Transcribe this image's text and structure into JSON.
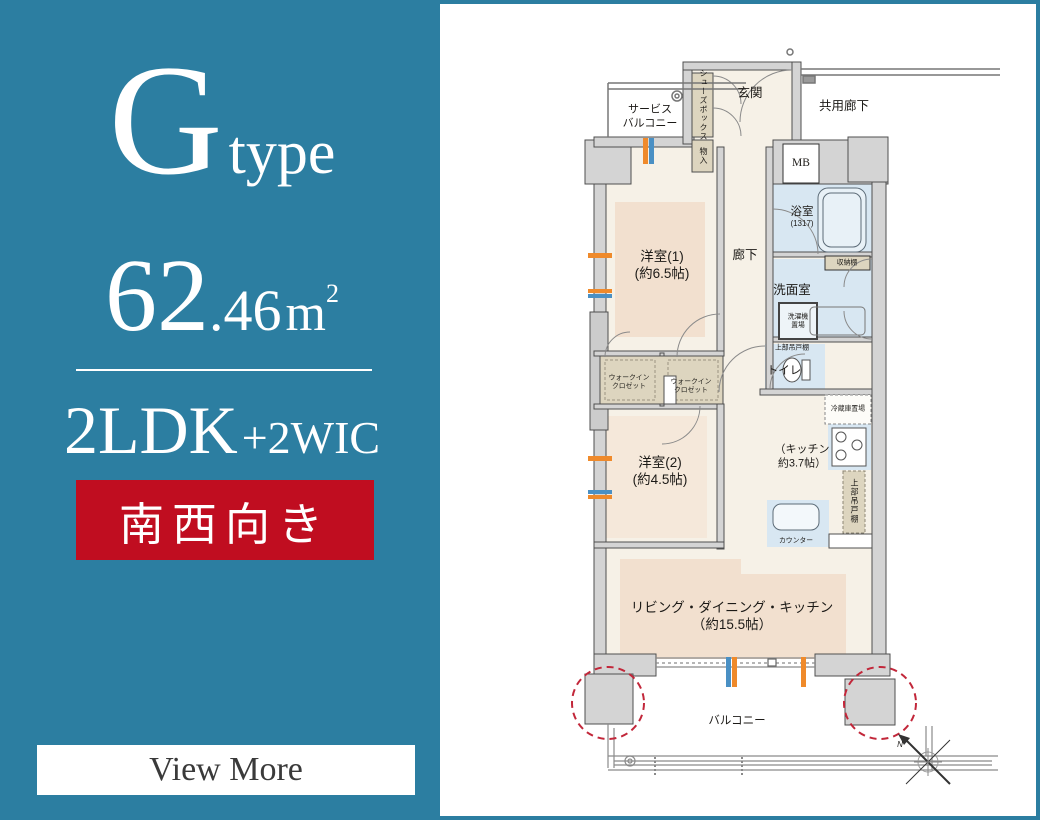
{
  "left_panel": {
    "type_letter": "G",
    "type_suffix": "type",
    "area_int": "62",
    "area_dec": ".46",
    "area_unit_m": "m",
    "area_unit_sup": "2",
    "layout_main": "2LDK",
    "layout_plus": "+2WIC",
    "direction_badge": "南西向き",
    "view_more": "View More"
  },
  "colors": {
    "panel_teal": "#2c7ea1",
    "badge_red": "#c00d20",
    "room_cream": "#f6f1e7",
    "tatami_peach": "#f2e0cf",
    "wet_area_blue": "#d8e7f2",
    "closet_beige": "#ddd5bf",
    "wall_gray": "#d4d4d4",
    "pillar_circle_red": "#c2273a",
    "window_orange": "#ef8a2b",
    "window_blue": "#4a90c4"
  },
  "floor_plan": {
    "labels": {
      "service_balcony_1": "サービス",
      "service_balcony_2": "バルコニー",
      "genkan": "玄関",
      "kyoyo_roka": "共用廊下",
      "mb": "MB",
      "shoes_box": "シューズボックス",
      "mono_ire": "物入",
      "yoshitsu1_name": "洋室(1)",
      "yoshitsu1_size": "(約6.5帖)",
      "roka": "廊下",
      "yokushitsu": "浴室",
      "yokushitsu_size": "(1317)",
      "senmenshitsu": "洗面室",
      "shunodana": "収納棚",
      "sentakuki_1": "洗濯機",
      "sentakuki_2": "置場",
      "jobu_tsuridana_toilet": "上部吊戸棚",
      "toire": "トイレ",
      "wic_line1": "ウォークイン",
      "wic_line2": "クロゼット",
      "yoshitsu2_name": "洋室(2)",
      "yoshitsu2_size": "(約4.5帖)",
      "kitchen_1": "（キッチン",
      "kitchen_2": "約3.7帖）",
      "reizoko": "冷蔵庫置場",
      "jobu_tsuridana_kitchen": "上部吊戸棚",
      "counter": "カウンター",
      "ldk_1": "リビング・ダイニング・キッチン",
      "ldk_2": "（約15.5帖）",
      "balcony": "バルコニー",
      "north": "N"
    }
  }
}
